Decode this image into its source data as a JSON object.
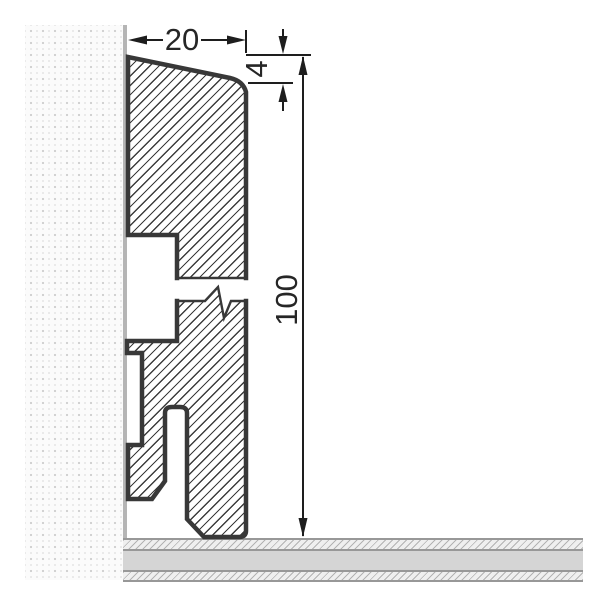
{
  "drawing": {
    "description": "Technical cross-section of a skirting board mounted against a wall on a floor, shown with a vertical break symbol",
    "dimension_labels": {
      "width": "20",
      "top_chamfer": "4",
      "height": "100"
    },
    "colors": {
      "background": "#ffffff",
      "profile_outline": "#383838",
      "profile_hatch": "#3c3c3c",
      "dimension_lines": "#1e1e1e",
      "dimension_text": "#262626",
      "wall_surface_line": "#b5b5b5",
      "wall_dots": "#d2d2d2",
      "wall_background": "#fbfbfb",
      "floor_core": "#d5d5d5",
      "floor_hatch": "#b3b3b3",
      "floor_border": "#989898"
    }
  }
}
